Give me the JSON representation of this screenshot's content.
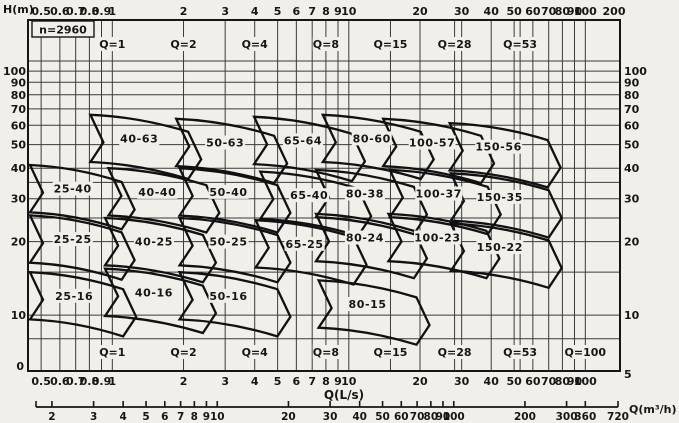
{
  "chart_data": {
    "type": "pump-selection-map",
    "title": "Pump performance range chart",
    "speed_label": "n=2960",
    "ylabel": "H(m)",
    "xlabel_primary": "Q(L/s)",
    "xlabel_secondary": "Q(m³/h)",
    "x_ticks_top": [
      0.5,
      0.6,
      0.7,
      0.8,
      0.9,
      1,
      2,
      3,
      4,
      5,
      6,
      7,
      8,
      9,
      10,
      20,
      30,
      40,
      50,
      60,
      70,
      80,
      90,
      100,
      200
    ],
    "x_ticks_bottom": [
      0.5,
      0.6,
      0.7,
      0.8,
      0.9,
      1,
      2,
      3,
      4,
      5,
      6,
      7,
      8,
      9,
      10,
      20,
      30,
      40,
      50,
      60,
      70,
      80,
      90,
      100
    ],
    "x2_ticks": [
      2,
      3,
      4,
      5,
      6,
      7,
      8,
      9,
      10,
      20,
      30,
      40,
      50,
      60,
      70,
      80,
      90,
      100,
      200,
      300,
      360,
      720
    ],
    "y_ticks": [
      10,
      20,
      30,
      40,
      50,
      60,
      70,
      80,
      90,
      100
    ],
    "grid_x_extra": [
      15,
      28,
      53
    ],
    "grid_y_extra": [
      8,
      15,
      25,
      35,
      110
    ],
    "corner_left_label": "0",
    "corner_right_label": "5",
    "q_marker_prefix": "Q=",
    "q_markers_top": [
      1,
      2,
      4,
      8,
      15,
      28,
      53
    ],
    "q_markers_bottom": [
      1,
      2,
      4,
      8,
      15,
      28,
      53,
      100
    ],
    "regions": [
      {
        "label": "40-63",
        "q": 1.3,
        "h": 53
      },
      {
        "label": "50-63",
        "q": 3.0,
        "h": 51
      },
      {
        "label": "65-64",
        "q": 6.4,
        "h": 52
      },
      {
        "label": "80-60",
        "q": 12.5,
        "h": 53
      },
      {
        "label": "100-57",
        "q": 22.5,
        "h": 51
      },
      {
        "label": "150-56",
        "q": 43,
        "h": 49
      },
      {
        "label": "25-40",
        "q": 0.68,
        "h": 33
      },
      {
        "label": "40-40",
        "q": 1.55,
        "h": 32
      },
      {
        "label": "50-40",
        "q": 3.1,
        "h": 32
      },
      {
        "label": "65-40",
        "q": 6.8,
        "h": 31
      },
      {
        "label": "80-38",
        "q": 11.7,
        "h": 31.5
      },
      {
        "label": "100-37",
        "q": 24,
        "h": 31.5
      },
      {
        "label": "150-35",
        "q": 43.5,
        "h": 30.5
      },
      {
        "label": "25-25",
        "q": 0.68,
        "h": 20.5
      },
      {
        "label": "40-25",
        "q": 1.5,
        "h": 20
      },
      {
        "label": "50-25",
        "q": 3.1,
        "h": 20
      },
      {
        "label": "65-25",
        "q": 6.5,
        "h": 19.6
      },
      {
        "label": "80-24",
        "q": 11.7,
        "h": 20.8
      },
      {
        "label": "100-23",
        "q": 23.7,
        "h": 20.8
      },
      {
        "label": "150-22",
        "q": 43.5,
        "h": 19
      },
      {
        "label": "25-16",
        "q": 0.69,
        "h": 12
      },
      {
        "label": "40-16",
        "q": 1.5,
        "h": 12.4
      },
      {
        "label": "50-16",
        "q": 3.1,
        "h": 12
      },
      {
        "label": "80-15",
        "q": 12,
        "h": 11.1
      }
    ],
    "colors": {
      "paper": "#f1efe9",
      "ink": "#161616",
      "grid": "#3a3a3a",
      "region_stroke": "#111111"
    }
  }
}
